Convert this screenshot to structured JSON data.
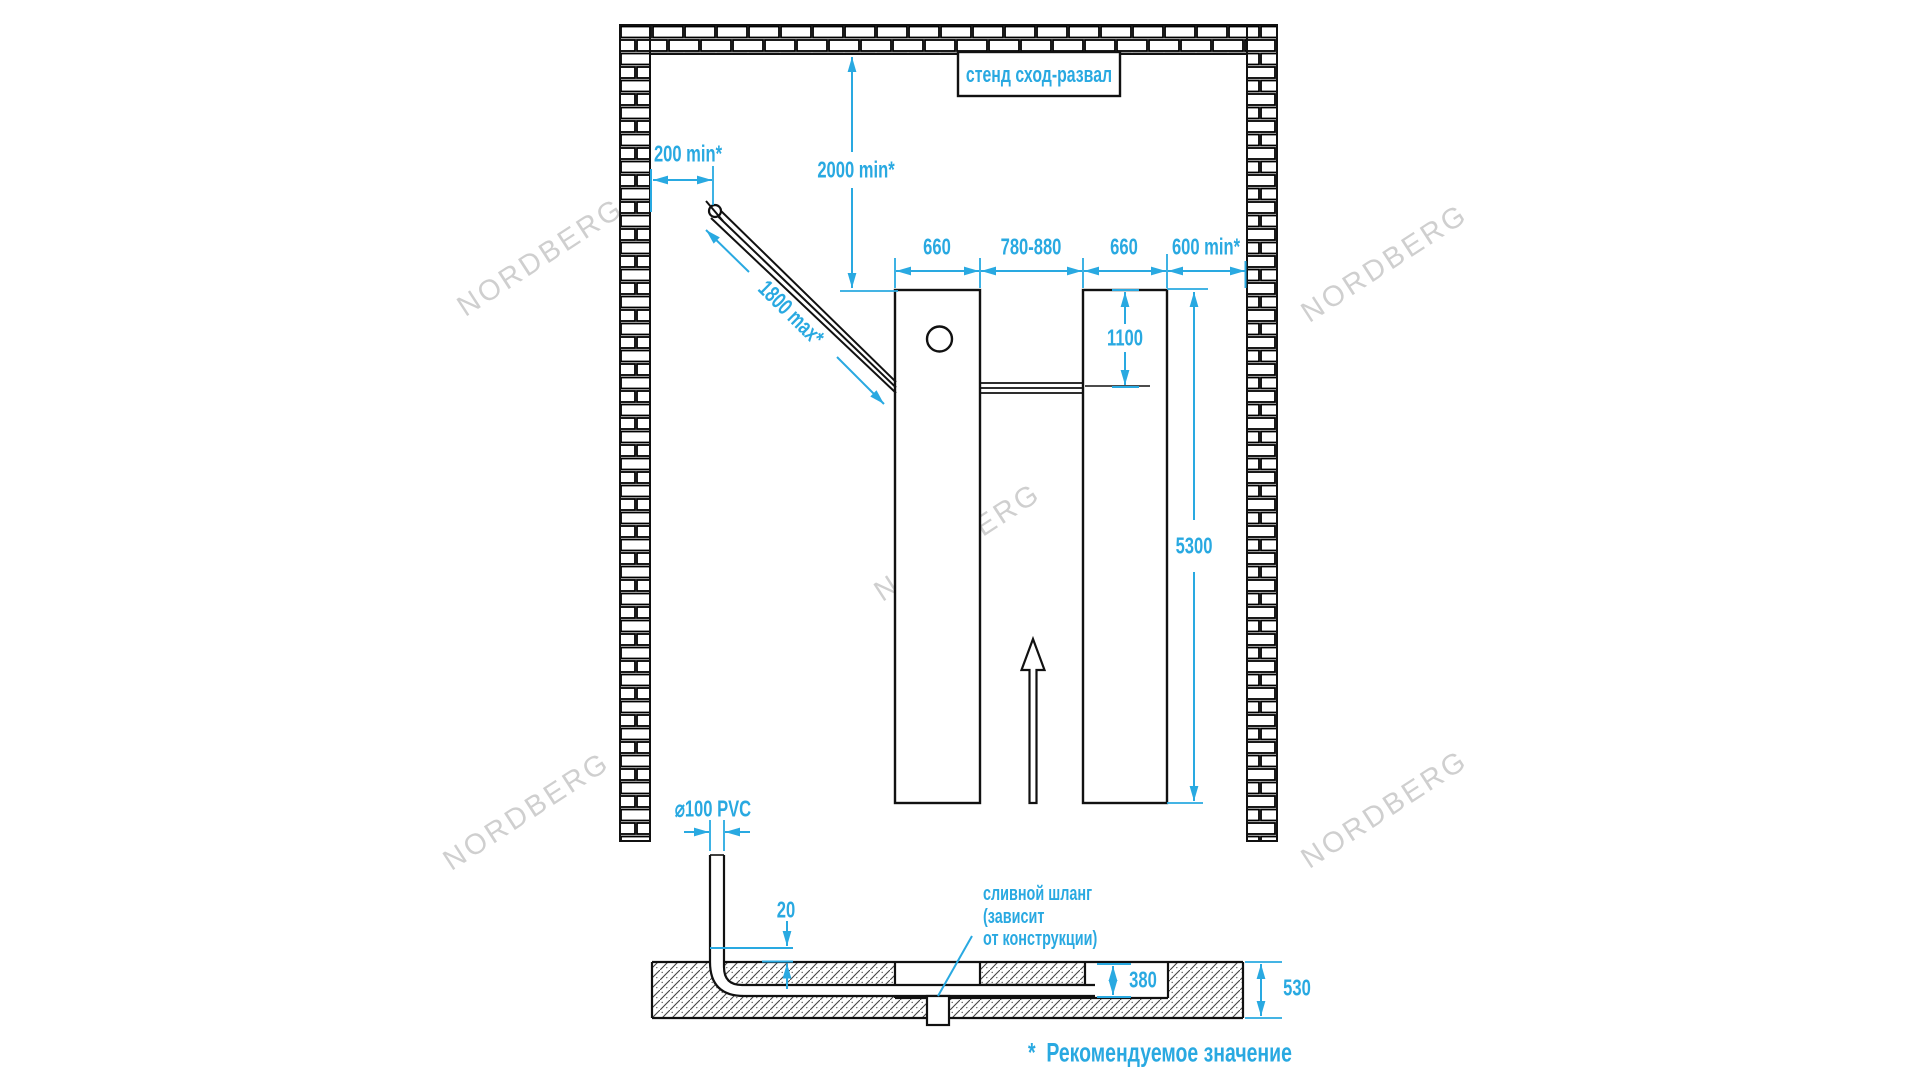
{
  "colors": {
    "accent": "#29a9e1",
    "line": "#111111",
    "watermark": "#cfcfcf"
  },
  "title_box": {
    "label": "стенд сход-развал"
  },
  "dimensions": {
    "wall_clearance_left": "200 min*",
    "ceiling_clearance": "2000 min*",
    "hose_length": "1800 max*",
    "platform_width_left": "660",
    "track_gap": "780-880",
    "platform_width_right": "660",
    "wall_clearance_right": "600 min*",
    "hose_entry_height": "1100",
    "platform_length": "5300",
    "pipe_diameter": "⌀100 PVC",
    "pipe_above_floor": "20",
    "trench_depth": "380",
    "foundation_depth": "530"
  },
  "annotations": {
    "drain_hose_line1": "сливной шланг",
    "drain_hose_line2": "(зависит",
    "drain_hose_line3": "от конструкции)",
    "footnote": "*  Рекомендуемое значение"
  },
  "watermark": {
    "text": "NORDBERG"
  }
}
